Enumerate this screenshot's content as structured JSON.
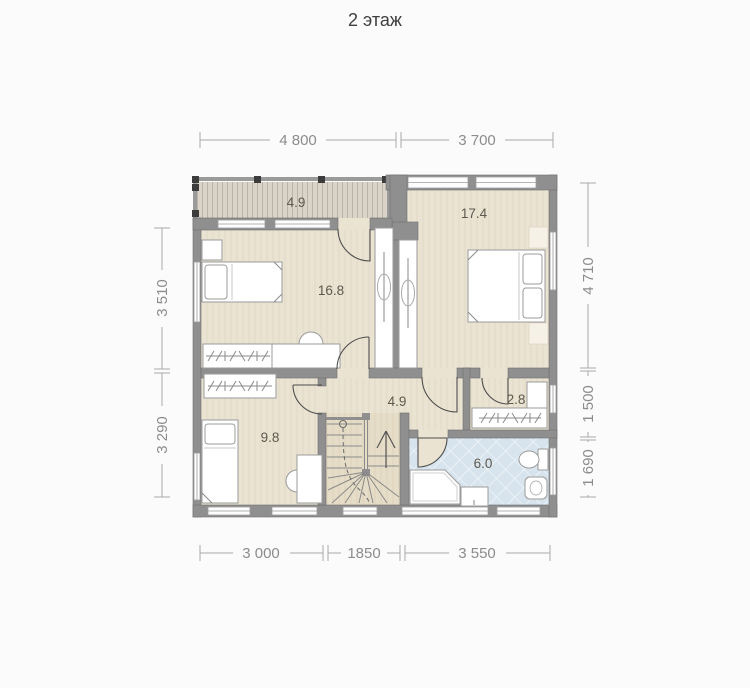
{
  "title": "2 этаж",
  "plan": {
    "rooms": [
      {
        "id": "balcony",
        "area": "4.9"
      },
      {
        "id": "bedroom-right",
        "area": "17.4"
      },
      {
        "id": "bedroom-left",
        "area": "16.8"
      },
      {
        "id": "hall",
        "area": "4.9"
      },
      {
        "id": "closet",
        "area": "2.8"
      },
      {
        "id": "bedroom-bottom",
        "area": "9.8"
      },
      {
        "id": "bathroom",
        "area": "6.0"
      }
    ],
    "dimensions": {
      "top": [
        "4 800",
        "3 700"
      ],
      "bottom": [
        "3 000",
        "1850",
        "3 550"
      ],
      "left": [
        "3 510",
        "3 290"
      ],
      "right": [
        "4 710",
        "1 500",
        "1 690"
      ]
    },
    "colors": {
      "wall": "#8f8f8f",
      "floor": "#eae3d2",
      "stairs_floor": "#e6ddc8",
      "bath_tile": "#d7e4ed",
      "balcony_floor": "#d9d4c7",
      "dimension_text": "#8c8c8c",
      "room_label": "#5e584e",
      "title_text": "#3f3f3f"
    }
  }
}
